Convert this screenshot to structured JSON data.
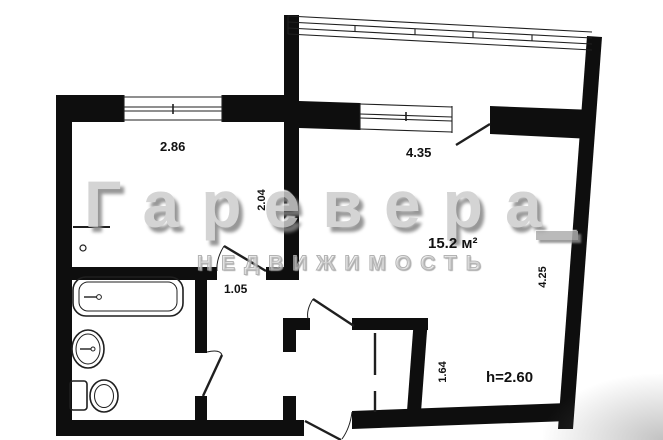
{
  "watermark": {
    "line1": "Гаревера",
    "line2": "НЕДВИЖИМОСТЬ"
  },
  "labels": {
    "kitchen_width": "2.86",
    "room_width": "4.35",
    "kitchen_depth": "2.04",
    "room_area": "15.2 м²",
    "corridor_width": "1.05",
    "room_depth": "4.25",
    "hall_depth": "1.64",
    "ceiling_height": "h=2.60"
  },
  "fixtures": {
    "bathtub": "bathtub-icon",
    "sink": "sink-icon",
    "toilet": "toilet-icon"
  },
  "colors": {
    "wall": "#0e0e0e",
    "line": "#1f1f1f",
    "watermark_fill": "#cdcdcd",
    "watermark_shadow": "#858585",
    "label_text": "#111111",
    "background": "#ffffff"
  }
}
